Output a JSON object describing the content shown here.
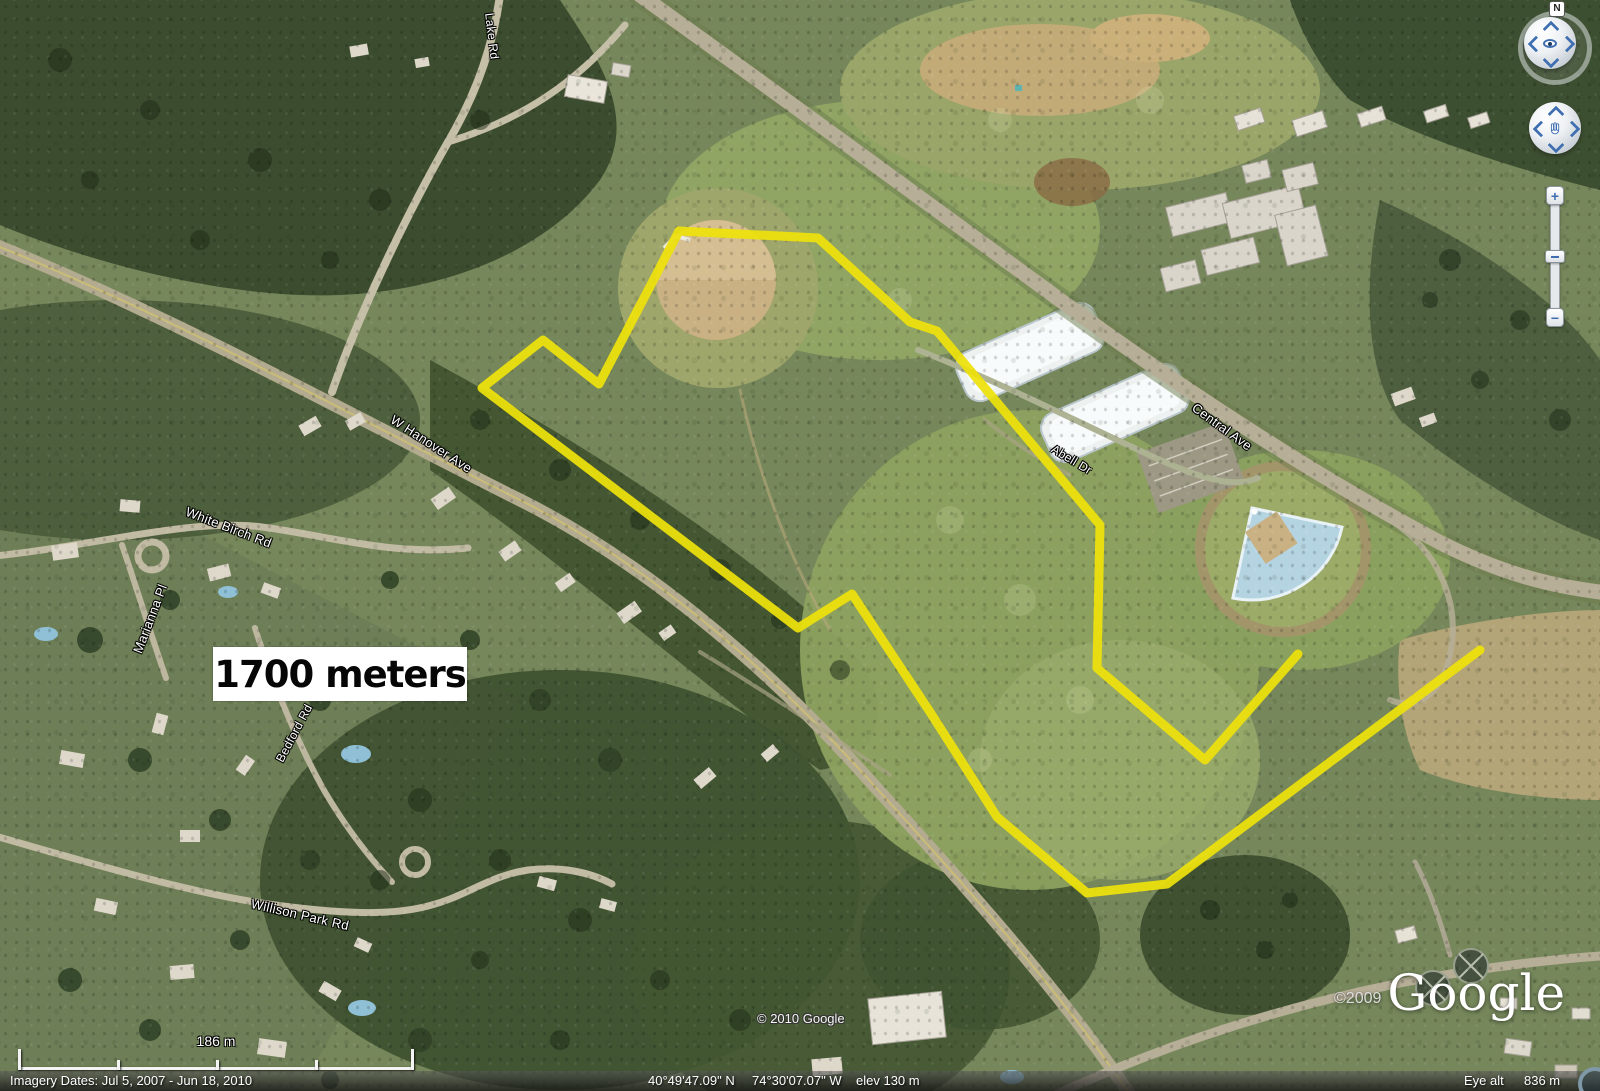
{
  "map": {
    "annotation": {
      "text": "1700 meters"
    }
  },
  "roads": {
    "lake": {
      "text": "Lake Rd"
    },
    "hanover": {
      "text": "W Hanover Ave"
    },
    "whitebirch": {
      "text": "White Birch Rd"
    },
    "marianna": {
      "text": "Marianna Pl"
    },
    "bedford": {
      "text": "Bedford Rd"
    },
    "willison": {
      "text": "Willison Park Rd"
    },
    "abell": {
      "text": "Abell Dr"
    },
    "central": {
      "text": "Central Ave"
    }
  },
  "route": {
    "color": "#eee20c",
    "upper": "679,231 818,238 910,322 937,331 1100,525 1097,668 1205,760 1298,654",
    "lower": "679,231 599,384 543,340 482,388 798,628 852,594 930,712 997,817 1087,893 1167,884 1480,650"
  },
  "navigation": {
    "north": "N",
    "zoom_in": "+",
    "zoom_out": "−"
  },
  "scale_bar": {
    "label": "186 m"
  },
  "status_bar": {
    "imagery": "Imagery Dates: Jul 5, 2007 - Jun 18, 2010",
    "lat": "40°49'47.09\" N",
    "lon": "74°30'07.07\" W",
    "elev": "elev 130 m",
    "eye_alt_label": "Eye alt",
    "eye_alt_value": "836 m"
  },
  "branding": {
    "map_copyright": "© 2010 Google",
    "logo_year": "©2009",
    "logo": "Google"
  }
}
